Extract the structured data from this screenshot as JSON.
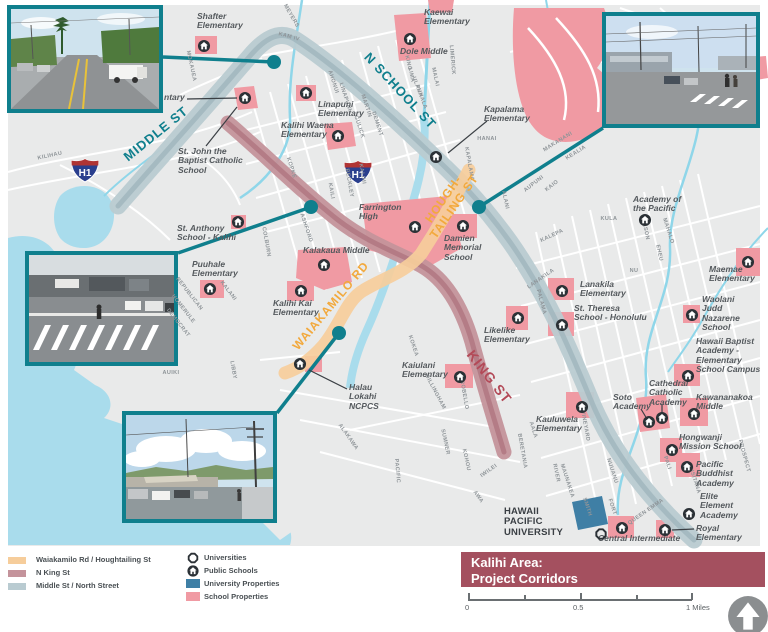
{
  "title_banner": {
    "line1": "Kalihi Area:",
    "line2": "Project Corridors"
  },
  "scale_bar": {
    "zero": "0",
    "half": "0.5",
    "one": "1 Miles"
  },
  "h1_shield": "H1",
  "colors": {
    "teal_accent": "#0f7f8d",
    "corridor_orange": "#f6cd9b",
    "corridor_mauve": "#c4939b",
    "corridor_blue": "#b9cbd1",
    "school_property_pink": "#f09aa3",
    "university_property_blue": "#3f7fa5",
    "banner_maroon": "#a4505f",
    "water": "#a9dcec",
    "map_background": "#e9eaea"
  },
  "legend": {
    "corridors": [
      {
        "label": "Waiakamilo Rd / Houghtailing St"
      },
      {
        "label": "N King St"
      },
      {
        "label": "Middle St / North Street"
      }
    ],
    "symbols": {
      "universities": "Universities",
      "public_schools": "Public Schools",
      "university_properties": "University Properties",
      "school_properties": "School Properties"
    }
  },
  "map": {
    "corridor_labels": [
      {
        "t": "MIDDLE ST",
        "x": 156,
        "y": 134,
        "rot": -39,
        "color": "#0f7f8d",
        "size": 13
      },
      {
        "t": "N SCHOOL ST",
        "x": 400,
        "y": 91,
        "rot": 47,
        "color": "#0f7f8d",
        "size": 13
      },
      {
        "t": "HOUGH-\nTAILING ST",
        "x": 449,
        "y": 203,
        "rot": -55,
        "color": "#f2a93d",
        "size": 12
      },
      {
        "t": "WAIAKAMILO RD",
        "x": 331,
        "y": 306,
        "rot": -50,
        "color": "#f2a93d",
        "size": 12
      },
      {
        "t": "KING ST",
        "x": 489,
        "y": 377,
        "rot": 52,
        "color": "#b34a58",
        "size": 14
      }
    ],
    "schools": [
      {
        "name": "Shafter\nElementary",
        "x": 197,
        "y": 12
      },
      {
        "name": "Kaewai\nElementary",
        "x": 424,
        "y": 8
      },
      {
        "name": "Dole Middle",
        "x": 400,
        "y": 47
      },
      {
        "name": "Linapuni\nElementary",
        "x": 318,
        "y": 100
      },
      {
        "name": "Kalihi Waena\nElementary",
        "x": 281,
        "y": 121
      },
      {
        "name": "Kapalama\nElementary",
        "x": 484,
        "y": 105
      },
      {
        "name": "St. John the\nBaptist Catholic\nSchool",
        "x": 178,
        "y": 147
      },
      {
        "name": "ntary",
        "x": 164,
        "y": 93
      },
      {
        "name": "St. Anthony\nSchool - Kalihi",
        "x": 177,
        "y": 224
      },
      {
        "name": "Puuhale\nElementary",
        "x": 192,
        "y": 260
      },
      {
        "name": "Kalakaua Middle",
        "x": 303,
        "y": 246
      },
      {
        "name": "Kalihi Kai\nElementary",
        "x": 273,
        "y": 299
      },
      {
        "name": "Farrington\nHigh",
        "x": 359,
        "y": 203
      },
      {
        "name": "Damien\nMemorial\nSchool",
        "x": 444,
        "y": 234
      },
      {
        "name": "Halau\nLokahi\nNCPCS",
        "x": 349,
        "y": 383
      },
      {
        "name": "Kaiulani\nElementary",
        "x": 402,
        "y": 361
      },
      {
        "name": "Likelike\nElementary",
        "x": 484,
        "y": 326
      },
      {
        "name": "Lanakila\nElementary",
        "x": 580,
        "y": 280
      },
      {
        "name": "St. Theresa\nSchool - Honolulu",
        "x": 574,
        "y": 304
      },
      {
        "name": "Maemae\nElementary",
        "x": 709,
        "y": 265
      },
      {
        "name": "Waolani\nJudd\nNazarene\nSchool",
        "x": 702,
        "y": 295
      },
      {
        "name": "Hawaii Baptist\nAcademy -\nElementary\nSchool Campus",
        "x": 696,
        "y": 337
      },
      {
        "name": "Academy of\nthe Pacific",
        "x": 633,
        "y": 195
      },
      {
        "name": "Soto\nAcademy",
        "x": 613,
        "y": 393
      },
      {
        "name": "Cathedral\nCatholic\nAcademy",
        "x": 649,
        "y": 379
      },
      {
        "name": "Kawananakoa\nMiddle",
        "x": 696,
        "y": 393
      },
      {
        "name": "Hongwanji\nMission School",
        "x": 679,
        "y": 433
      },
      {
        "name": "Pacific\nBuddhist\nAcademy",
        "x": 696,
        "y": 460
      },
      {
        "name": "Elite\nElement\nAcademy",
        "x": 700,
        "y": 492
      },
      {
        "name": "Royal\nElementary",
        "x": 696,
        "y": 524
      },
      {
        "name": "Kauluwela\nElementary",
        "x": 536,
        "y": 415
      },
      {
        "name": "Central Intermediate",
        "x": 598,
        "y": 534
      },
      {
        "name": "HAWAII\nPACIFIC\nUNIVERSITY",
        "x": 504,
        "y": 507,
        "cls": "hpu"
      }
    ],
    "school_icons": [
      {
        "x": 204,
        "y": 46
      },
      {
        "x": 410,
        "y": 39
      },
      {
        "x": 306,
        "y": 93
      },
      {
        "x": 338,
        "y": 136
      },
      {
        "x": 436,
        "y": 157
      },
      {
        "x": 245,
        "y": 98
      },
      {
        "x": 238,
        "y": 222
      },
      {
        "x": 210,
        "y": 289
      },
      {
        "x": 324,
        "y": 265
      },
      {
        "x": 301,
        "y": 291
      },
      {
        "x": 415,
        "y": 227
      },
      {
        "x": 463,
        "y": 226
      },
      {
        "x": 300,
        "y": 364
      },
      {
        "x": 460,
        "y": 377
      },
      {
        "x": 518,
        "y": 318
      },
      {
        "x": 562,
        "y": 291
      },
      {
        "x": 562,
        "y": 325
      },
      {
        "x": 748,
        "y": 262
      },
      {
        "x": 692,
        "y": 315
      },
      {
        "x": 688,
        "y": 376
      },
      {
        "x": 645,
        "y": 220
      },
      {
        "x": 649,
        "y": 422
      },
      {
        "x": 662,
        "y": 418
      },
      {
        "x": 694,
        "y": 414
      },
      {
        "x": 672,
        "y": 450
      },
      {
        "x": 687,
        "y": 467
      },
      {
        "x": 689,
        "y": 514
      },
      {
        "x": 665,
        "y": 530
      },
      {
        "x": 582,
        "y": 407
      },
      {
        "x": 622,
        "y": 528
      }
    ],
    "university_icons": [
      {
        "x": 601,
        "y": 534
      }
    ],
    "street_labels": [
      {
        "t": "KILIHAU",
        "x": 50,
        "y": 156,
        "rot": -12
      },
      {
        "t": "MOKAUEA",
        "x": 191,
        "y": 66,
        "rot": 78
      },
      {
        "t": "MEYERS",
        "x": 291,
        "y": 16,
        "rot": 60
      },
      {
        "t": "KAM IV",
        "x": 289,
        "y": 37,
        "rot": 15
      },
      {
        "t": "AHONUI",
        "x": 333,
        "y": 82,
        "rot": 72
      },
      {
        "t": "LINAPUNI",
        "x": 345,
        "y": 97,
        "rot": 72
      },
      {
        "t": "MARTIN",
        "x": 366,
        "y": 106,
        "rot": 72
      },
      {
        "t": "GULICK",
        "x": 359,
        "y": 127,
        "rot": 72
      },
      {
        "t": "DEMENT",
        "x": 377,
        "y": 124,
        "rot": 72
      },
      {
        "t": "KINO",
        "x": 408,
        "y": 63,
        "rot": 78
      },
      {
        "t": "LIMA",
        "x": 411,
        "y": 75,
        "rot": 78
      },
      {
        "t": "ULANA",
        "x": 417,
        "y": 87,
        "rot": 70
      },
      {
        "t": "PUHALA",
        "x": 421,
        "y": 97,
        "rot": 70
      },
      {
        "t": "MALAI",
        "x": 435,
        "y": 77,
        "rot": 78
      },
      {
        "t": "LIMERICK",
        "x": 452,
        "y": 60,
        "rot": 85
      },
      {
        "t": "HANAI",
        "x": 487,
        "y": 139,
        "rot": 0
      },
      {
        "t": "KAPALAMA",
        "x": 469,
        "y": 164,
        "rot": 80
      },
      {
        "t": "MAKANANI",
        "x": 558,
        "y": 142,
        "rot": -32
      },
      {
        "t": "KEALIA",
        "x": 576,
        "y": 153,
        "rot": -32
      },
      {
        "t": "AUPUNI",
        "x": 534,
        "y": 184,
        "rot": -38
      },
      {
        "t": "KAIO",
        "x": 552,
        "y": 186,
        "rot": -38
      },
      {
        "t": "ALANI",
        "x": 505,
        "y": 200,
        "rot": 78
      },
      {
        "t": "KOPKE",
        "x": 291,
        "y": 168,
        "rot": 72
      },
      {
        "t": "BECKLEY",
        "x": 349,
        "y": 183,
        "rot": 80
      },
      {
        "t": "KAILI",
        "x": 331,
        "y": 191,
        "rot": 80
      },
      {
        "t": "KALIHI",
        "x": 362,
        "y": 174,
        "rot": 80
      },
      {
        "t": "ASHFORD",
        "x": 306,
        "y": 228,
        "rot": 72
      },
      {
        "t": "COLBURN",
        "x": 266,
        "y": 242,
        "rot": 80
      },
      {
        "t": "REPUBLICAN",
        "x": 189,
        "y": 294,
        "rot": 52
      },
      {
        "t": "HOMERULE",
        "x": 183,
        "y": 309,
        "rot": 52
      },
      {
        "t": "DEMOCRAT",
        "x": 178,
        "y": 323,
        "rot": 52
      },
      {
        "t": "KALANI",
        "x": 228,
        "y": 291,
        "rot": 52
      },
      {
        "t": "AUIKI",
        "x": 171,
        "y": 373,
        "rot": 0
      },
      {
        "t": "LIBBY",
        "x": 233,
        "y": 370,
        "rot": 80
      },
      {
        "t": "KOKEA",
        "x": 413,
        "y": 346,
        "rot": 72
      },
      {
        "t": "DILLINGHAM",
        "x": 435,
        "y": 392,
        "rot": 62
      },
      {
        "t": "ALAKAWA",
        "x": 348,
        "y": 437,
        "rot": 55
      },
      {
        "t": "PACIFIC",
        "x": 397,
        "y": 471,
        "rot": 85
      },
      {
        "t": "SUMNER",
        "x": 445,
        "y": 442,
        "rot": 78
      },
      {
        "t": "KOHOU",
        "x": 466,
        "y": 460,
        "rot": 78
      },
      {
        "t": "IWILEI",
        "x": 489,
        "y": 471,
        "rot": -35
      },
      {
        "t": "AWA",
        "x": 478,
        "y": 497,
        "rot": 55
      },
      {
        "t": "ROBELLO",
        "x": 464,
        "y": 395,
        "rot": 80
      },
      {
        "t": "KALEPA",
        "x": 552,
        "y": 236,
        "rot": -25
      },
      {
        "t": "KULA",
        "x": 609,
        "y": 219,
        "rot": 0
      },
      {
        "t": "MASON",
        "x": 645,
        "y": 229,
        "rot": 78
      },
      {
        "t": "MAHALO",
        "x": 668,
        "y": 231,
        "rot": 72
      },
      {
        "t": "EHEU",
        "x": 659,
        "y": 253,
        "rot": 78
      },
      {
        "t": "NU",
        "x": 634,
        "y": 271,
        "rot": 0
      },
      {
        "t": "LANAKILA",
        "x": 541,
        "y": 279,
        "rot": -35
      },
      {
        "t": "PALAMA",
        "x": 541,
        "y": 302,
        "rot": 75
      },
      {
        "t": "AALA",
        "x": 533,
        "y": 430,
        "rot": 72
      },
      {
        "t": "RIVER",
        "x": 556,
        "y": 473,
        "rot": 78
      },
      {
        "t": "VINEYARD",
        "x": 585,
        "y": 426,
        "rot": 80
      },
      {
        "t": "MAUNAKEA",
        "x": 567,
        "y": 481,
        "rot": 72
      },
      {
        "t": "NUUANU",
        "x": 612,
        "y": 471,
        "rot": 72
      },
      {
        "t": "PALI",
        "x": 667,
        "y": 463,
        "rot": 72
      },
      {
        "t": "FORT",
        "x": 612,
        "y": 507,
        "rot": 72
      },
      {
        "t": "SMITH",
        "x": 587,
        "y": 507,
        "rot": 72
      },
      {
        "t": "QUEEN EMMA",
        "x": 646,
        "y": 512,
        "rot": -35
      },
      {
        "t": "BERETANIA",
        "x": 522,
        "y": 451,
        "rot": 80
      },
      {
        "t": "PROSPECT",
        "x": 744,
        "y": 456,
        "rot": 75
      },
      {
        "t": "LUSITANA",
        "x": 694,
        "y": 479,
        "rot": 72
      }
    ]
  }
}
